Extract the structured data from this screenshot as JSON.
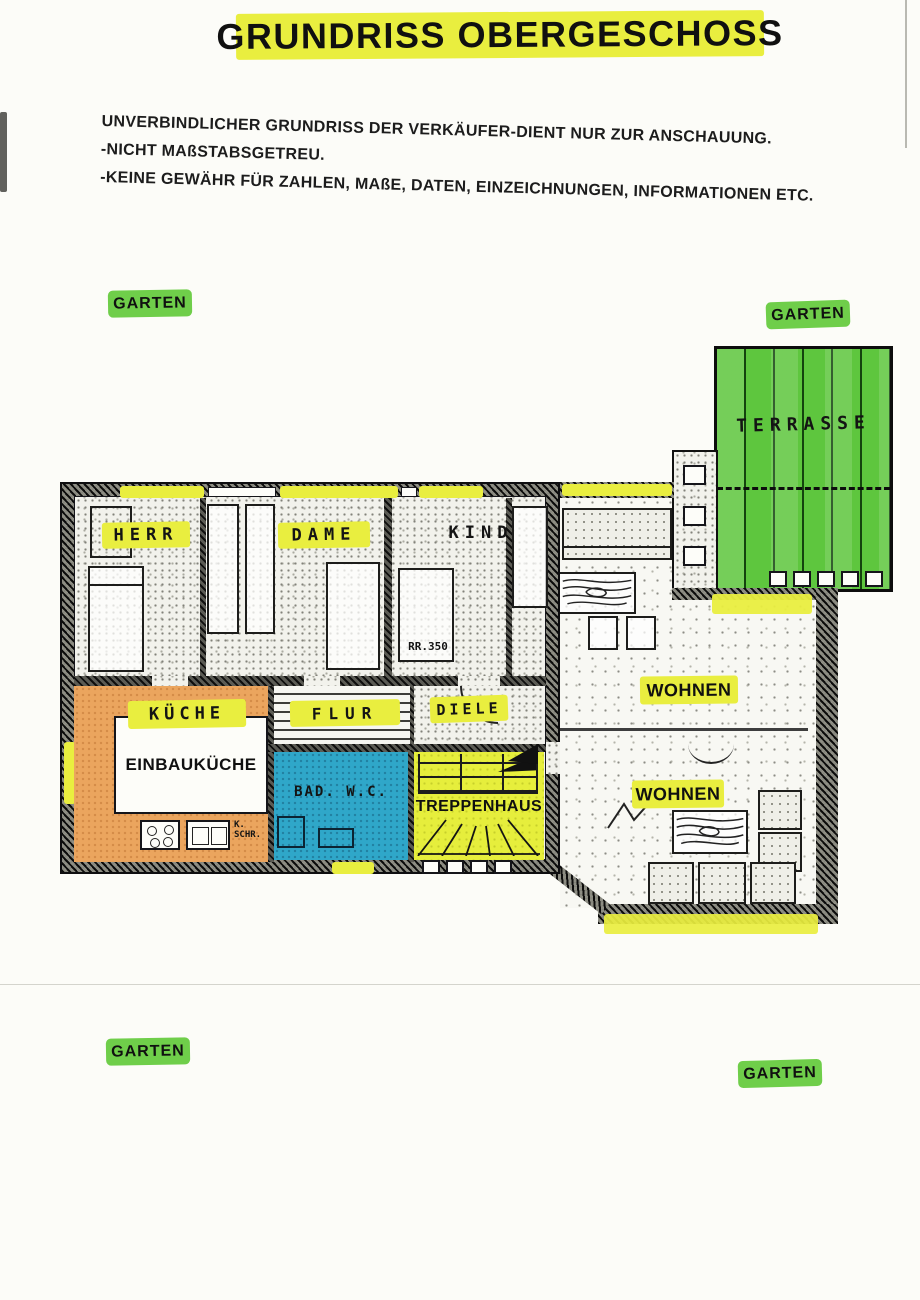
{
  "page": {
    "title": "GRUNDRISS OBERGESCHOSS",
    "disclaimer_lines": [
      "UNVERBINDLICHER GRUNDRISS DER VERKÄUFER-DIENT NUR ZUR ANSCHAUUNG.",
      "-NICHT MAßSTABSGETREU.",
      "-KEINE GEWÄHR FÜR ZAHLEN, MAßE, DATEN, EINZEICHNUNGEN, INFORMATIONEN ETC."
    ]
  },
  "garden": {
    "top_left": "GARTEN",
    "top_right": "GARTEN",
    "bottom_left": "GARTEN",
    "bottom_right": "GARTEN"
  },
  "rooms": {
    "herr": "HERR",
    "dame": "DAME",
    "kind": "KIND",
    "terrasse": "TERRASSE",
    "kueche": "KÜCHE",
    "flur": "FLUR",
    "diele": "DIELE",
    "einbaukueche": "EINBAUKÜCHE",
    "bad_wc": "BAD. W.C.",
    "treppenhaus": "TREPPENHAUS",
    "wohnen_upper": "WOHNEN",
    "wohnen_lower": "WOHNEN"
  },
  "annotations": {
    "bed_note": "RR.350",
    "fridge": "K. SCHR."
  },
  "colors": {
    "highlight_yellow": "#e9ee3f",
    "garden_green": "#6fce4a",
    "terrace_green": "#5ec63e",
    "kitchen_orange": "#eba55e",
    "bath_blue": "#2fa7c9",
    "stairs_yellow": "#e6ee3c"
  }
}
